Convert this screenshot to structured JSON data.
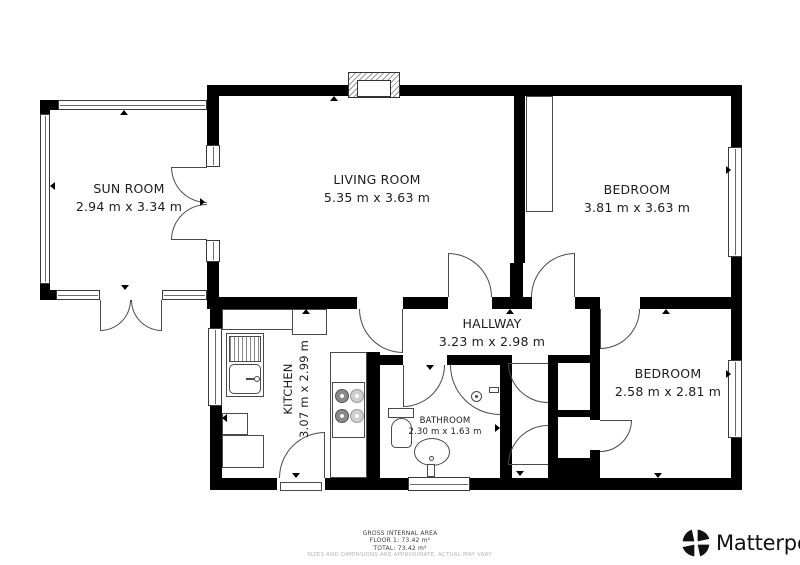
{
  "plan": {
    "rooms": [
      {
        "id": "sun-room",
        "name": "SUN ROOM",
        "dims": "2.94 m x 3.34 m"
      },
      {
        "id": "living-room",
        "name": "LIVING ROOM",
        "dims": "5.35 m x 3.63 m"
      },
      {
        "id": "bedroom-1",
        "name": "BEDROOM",
        "dims": "3.81 m x 3.63 m"
      },
      {
        "id": "hallway",
        "name": "HALLWAY",
        "dims": "3.23 m x 2.98 m"
      },
      {
        "id": "kitchen",
        "name": "KITCHEN",
        "dims": "3.07 m x 2.99 m"
      },
      {
        "id": "bathroom",
        "name": "BATHROOM",
        "dims": "2.30 m x 1.63 m"
      },
      {
        "id": "bedroom-2",
        "name": "BEDROOM",
        "dims": "2.58 m x 2.81 m"
      }
    ]
  },
  "footer": {
    "area_title": "GROSS INTERNAL AREA",
    "floor_line": "FLOOR 1: 73.42 m²",
    "total_line": "TOTAL: 73.42 m²",
    "disclaimer": "SIZES AND DIMENSIONS ARE APPROXIMATE, ACTUAL MAY VARY."
  },
  "branding": {
    "name": "Matterport",
    "mark": "®"
  },
  "colors": {
    "wall": "#000000",
    "line": "#4a4a4a",
    "floor": "#ffffff",
    "muted_text": "#b4b4b4"
  }
}
